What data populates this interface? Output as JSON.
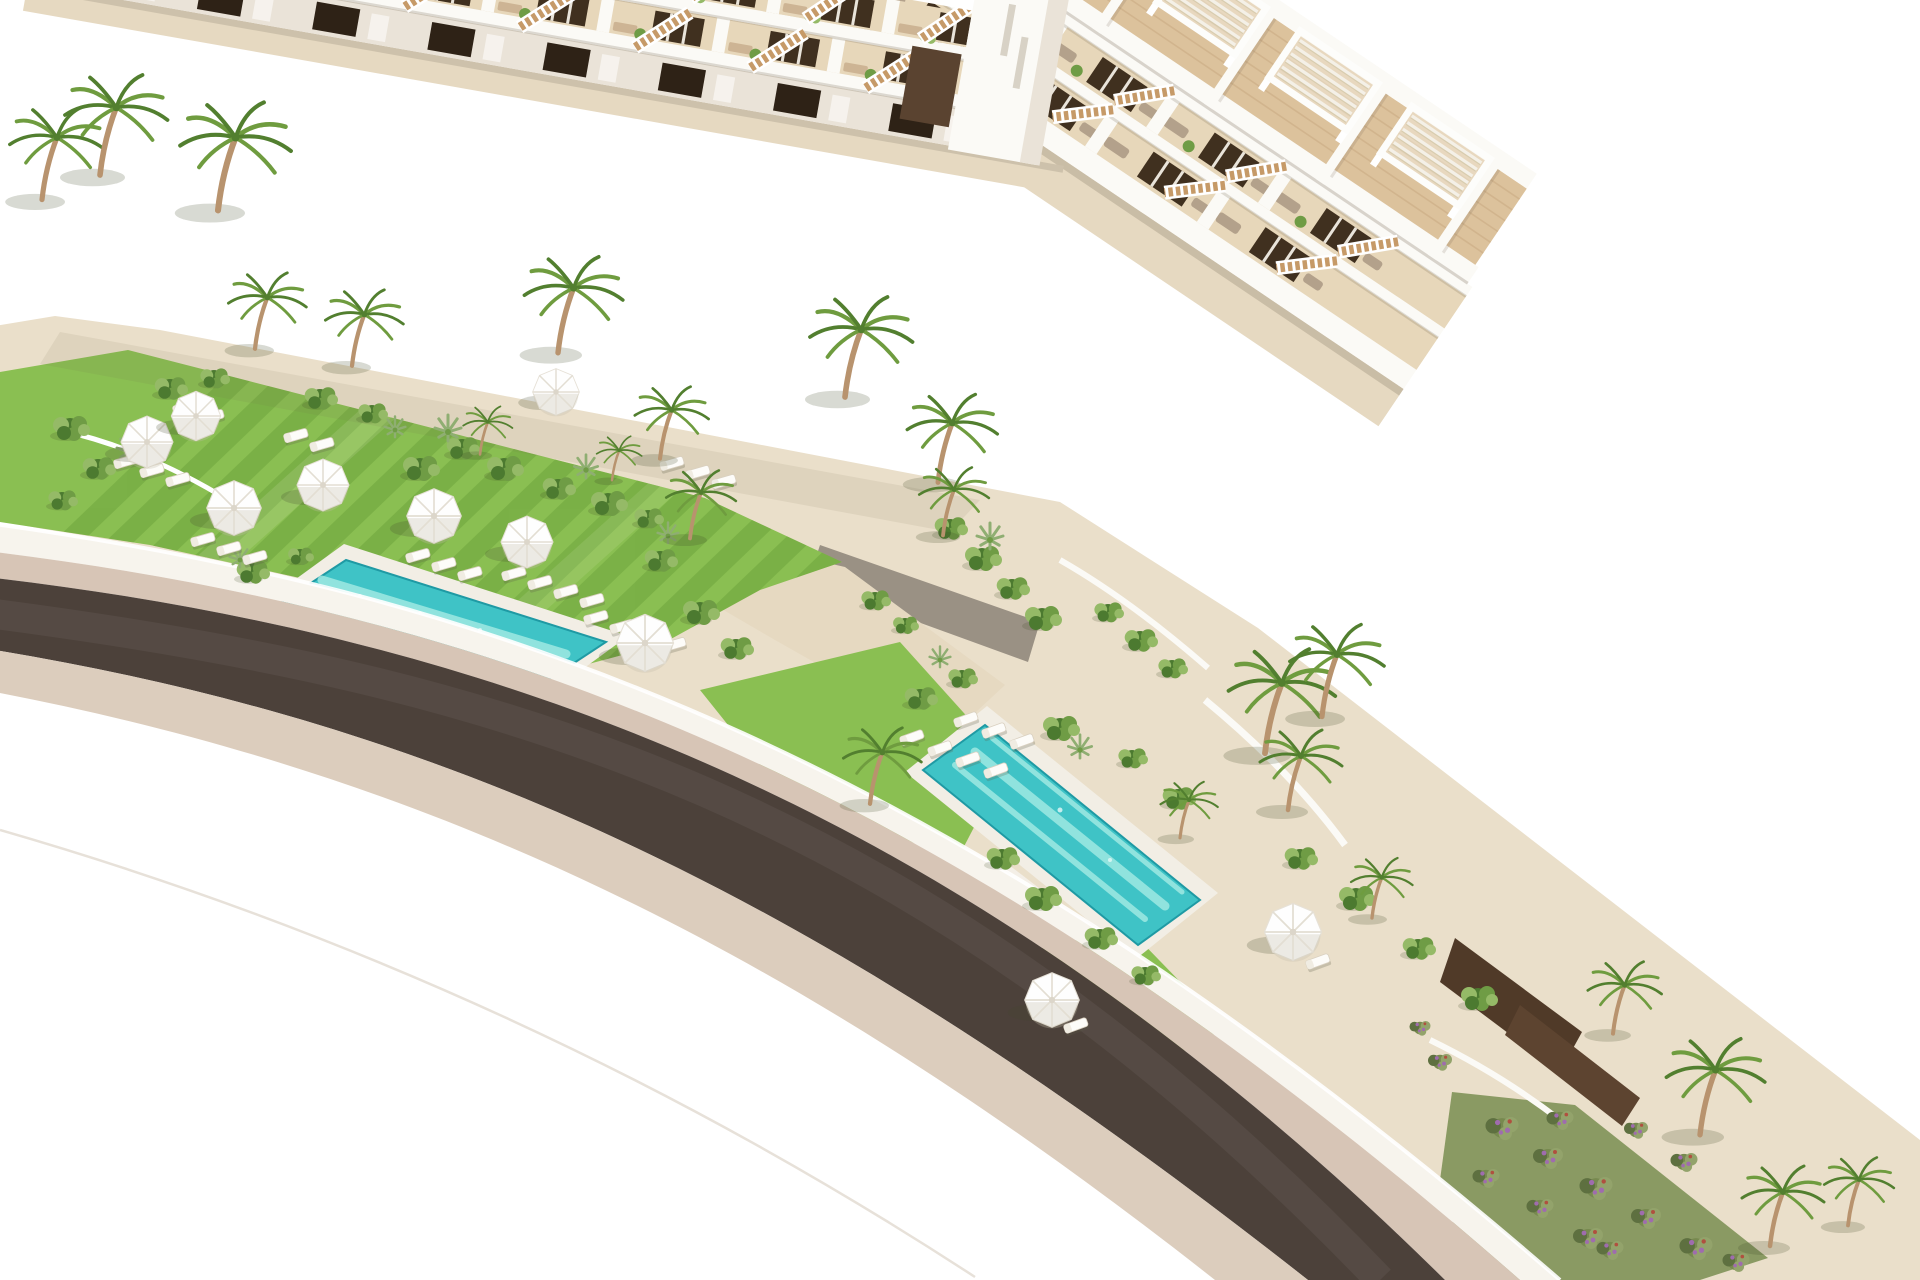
{
  "image": {
    "type": "3d-architectural-render",
    "subject": "Aerial rendering of a modern white terraced apartment resort: long apartment block with rooftop pergolas at the left, a stepped townhouse row descending to the lower right, lawns with white parasols and sun loungers, two turquoise swimming pools, palm trees and a curved dark road in the foreground",
    "width": 1920,
    "height": 1280
  },
  "palette": {
    "sky": "#ffffff",
    "building-white": "#fbfaf6",
    "building-shadow": "#eae3d8",
    "terrace-back": "#e7d7ba",
    "terrace-floor": "#e2cda6",
    "wood-deck": "#dcc29c",
    "plank-line": "#c8a981",
    "window-dark": "#40301f",
    "door-dark": "#2e2216",
    "stair-wood": "#c69a68",
    "lounger-gray": "#b3a18b",
    "lounger-tan": "#cdb494",
    "lawn": "#8abf52",
    "lawn-stripe": "#5c9431",
    "shrub-dark": "#4c7a30",
    "shrub-mid": "#6f9c45",
    "shrub-light": "#95ba67",
    "agave": "#8fae72",
    "flower-purple": "#9f6cae",
    "palm-green": "#6f9c3f",
    "palm-dark": "#527f2f",
    "palm-trunk": "#b8936e",
    "pool-water": "#3fc3c6",
    "pool-light": "#a5ece4",
    "pool-deep": "#1f9aa4",
    "pool-deck": "#f2eee5",
    "road": "#4c413a",
    "sidewalk": "#d7c5b6",
    "sidewalk-outer": "#dccdbd",
    "path-gray": "#c9c6b9",
    "path-sand": "#e6d9c1",
    "ground-sand": "#eadfca",
    "wall-white": "#f7f4ed",
    "wall-shade": "#d9d0c0"
  },
  "scene": {
    "left_building": {
      "units": 8,
      "floors": 3,
      "rooftop_pergolas": 8,
      "angle_deg": 10
    },
    "right_building": {
      "units": 10,
      "floors": 3,
      "rooftop_pergolas": 10,
      "angle_deg": 34
    },
    "pools": [
      {
        "name": "main-pool",
        "water": "276,606 346,560 606,642 536,688",
        "deck": "256,608 344,544 628,636 535,704"
      },
      {
        "name": "second-pool",
        "water": "923,770 985,725 1200,900 1138,945",
        "deck": "905,772 987,706 1218,893 1136,959"
      }
    ],
    "palms": [
      {
        "x": 42,
        "y": 195,
        "s": 1.15
      },
      {
        "x": 100,
        "y": 170,
        "s": 1.25
      },
      {
        "x": 218,
        "y": 205,
        "s": 1.35
      },
      {
        "x": 255,
        "y": 345,
        "s": 0.95
      },
      {
        "x": 352,
        "y": 362,
        "s": 0.95
      },
      {
        "x": 558,
        "y": 348,
        "s": 1.2
      },
      {
        "x": 660,
        "y": 455,
        "s": 0.9
      },
      {
        "x": 690,
        "y": 535,
        "s": 0.85
      },
      {
        "x": 845,
        "y": 392,
        "s": 1.25
      },
      {
        "x": 938,
        "y": 478,
        "s": 1.1
      },
      {
        "x": 943,
        "y": 532,
        "s": 0.85
      },
      {
        "x": 870,
        "y": 800,
        "s": 0.95
      },
      {
        "x": 1265,
        "y": 748,
        "s": 1.3
      },
      {
        "x": 1322,
        "y": 712,
        "s": 1.15
      },
      {
        "x": 1288,
        "y": 806,
        "s": 1.0
      },
      {
        "x": 1372,
        "y": 915,
        "s": 0.75
      },
      {
        "x": 1613,
        "y": 1030,
        "s": 0.9
      },
      {
        "x": 1700,
        "y": 1130,
        "s": 1.2
      },
      {
        "x": 1770,
        "y": 1242,
        "s": 1.0
      },
      {
        "x": 1848,
        "y": 1222,
        "s": 0.85
      },
      {
        "x": 480,
        "y": 452,
        "s": 0.6
      },
      {
        "x": 612,
        "y": 478,
        "s": 0.55
      },
      {
        "x": 1180,
        "y": 835,
        "s": 0.7
      }
    ],
    "umbrellas": [
      {
        "x": 147,
        "y": 442,
        "s": 1.0
      },
      {
        "x": 196,
        "y": 416,
        "s": 0.95
      },
      {
        "x": 234,
        "y": 508,
        "s": 1.05
      },
      {
        "x": 323,
        "y": 485,
        "s": 1.0
      },
      {
        "x": 434,
        "y": 516,
        "s": 1.05
      },
      {
        "x": 527,
        "y": 542,
        "s": 1.0
      },
      {
        "x": 556,
        "y": 392,
        "s": 0.9
      },
      {
        "x": 645,
        "y": 643,
        "s": 1.1
      },
      {
        "x": 1052,
        "y": 1000,
        "s": 1.05
      },
      {
        "x": 1293,
        "y": 932,
        "s": 1.1
      }
    ],
    "lounger_rows": [
      {
        "x": 185,
        "y": 408,
        "n": 2,
        "dx": 27,
        "dy": 9,
        "angle": -16
      },
      {
        "x": 126,
        "y": 462,
        "n": 3,
        "dx": 26,
        "dy": 9,
        "angle": -16
      },
      {
        "x": 203,
        "y": 540,
        "n": 3,
        "dx": 26,
        "dy": 9,
        "angle": -16
      },
      {
        "x": 296,
        "y": 436,
        "n": 2,
        "dx": 26,
        "dy": 9,
        "angle": -16
      },
      {
        "x": 418,
        "y": 556,
        "n": 3,
        "dx": 26,
        "dy": 9,
        "angle": -16
      },
      {
        "x": 514,
        "y": 574,
        "n": 4,
        "dx": 26,
        "dy": 9,
        "angle": -16
      },
      {
        "x": 596,
        "y": 618,
        "n": 4,
        "dx": 26,
        "dy": 9,
        "angle": -16
      },
      {
        "x": 672,
        "y": 464,
        "n": 3,
        "dx": 26,
        "dy": 9,
        "angle": -16
      },
      {
        "x": 912,
        "y": 738,
        "n": 4,
        "dx": 28,
        "dy": 11,
        "angle": -20
      },
      {
        "x": 966,
        "y": 720,
        "n": 3,
        "dx": 28,
        "dy": 11,
        "angle": -20
      },
      {
        "x": 1318,
        "y": 962,
        "n": 1,
        "dx": 0,
        "dy": 0,
        "angle": -20
      },
      {
        "x": 1076,
        "y": 1026,
        "n": 1,
        "dx": 0,
        "dy": 0,
        "angle": -20
      }
    ],
    "shrubs": {
      "bush": [
        [
          70,
          428,
          1
        ],
        [
          98,
          468,
          0.9
        ],
        [
          62,
          500,
          0.8
        ],
        [
          170,
          388,
          0.9
        ],
        [
          214,
          378,
          0.8
        ],
        [
          320,
          398,
          0.9
        ],
        [
          372,
          413,
          0.8
        ],
        [
          420,
          468,
          1
        ],
        [
          462,
          448,
          0.9
        ],
        [
          504,
          468,
          1
        ],
        [
          558,
          488,
          0.9
        ],
        [
          608,
          503,
          1
        ],
        [
          648,
          518,
          0.8
        ],
        [
          252,
          572,
          0.9
        ],
        [
          300,
          556,
          0.7
        ],
        [
          660,
          560,
          0.9
        ],
        [
          700,
          612,
          1
        ],
        [
          736,
          648,
          0.9
        ],
        [
          950,
          528,
          0.9
        ],
        [
          982,
          558,
          1
        ],
        [
          1012,
          588,
          0.9
        ],
        [
          1042,
          618,
          1
        ],
        [
          920,
          698,
          0.9
        ],
        [
          962,
          678,
          0.8
        ],
        [
          1060,
          728,
          1
        ],
        [
          1002,
          858,
          0.9
        ],
        [
          1042,
          898,
          1
        ],
        [
          1100,
          938,
          0.9
        ],
        [
          1145,
          975,
          0.8
        ],
        [
          1132,
          758,
          0.8
        ],
        [
          1178,
          798,
          0.9
        ],
        [
          1108,
          612,
          0.8
        ],
        [
          1140,
          640,
          0.9
        ],
        [
          1172,
          668,
          0.8
        ],
        [
          1300,
          858,
          0.9
        ],
        [
          1356,
          898,
          1
        ],
        [
          1418,
          948,
          0.9
        ],
        [
          1478,
          998,
          1
        ],
        [
          875,
          600,
          0.8
        ],
        [
          905,
          625,
          0.7
        ]
      ],
      "agave": [
        [
          130,
          452,
          1
        ],
        [
          448,
          432,
          1
        ],
        [
          586,
          470,
          0.9
        ],
        [
          668,
          536,
          0.8
        ],
        [
          990,
          540,
          1
        ],
        [
          1080,
          750,
          0.9
        ],
        [
          940,
          660,
          0.8
        ],
        [
          240,
          560,
          0.8
        ],
        [
          395,
          430,
          0.8
        ]
      ],
      "flower": [
        [
          1502,
          1128,
          1.1
        ],
        [
          1548,
          1158,
          1
        ],
        [
          1596,
          1188,
          1.1
        ],
        [
          1646,
          1218,
          1
        ],
        [
          1696,
          1248,
          1.1
        ],
        [
          1540,
          1208,
          0.9
        ],
        [
          1588,
          1238,
          1
        ],
        [
          1486,
          1178,
          0.9
        ],
        [
          1636,
          1130,
          0.8
        ],
        [
          1684,
          1162,
          0.9
        ],
        [
          1736,
          1262,
          0.9
        ],
        [
          1440,
          1062,
          0.8
        ],
        [
          1420,
          1028,
          0.7
        ],
        [
          1560,
          1120,
          0.9
        ],
        [
          1610,
          1250,
          0.9
        ]
      ]
    }
  }
}
